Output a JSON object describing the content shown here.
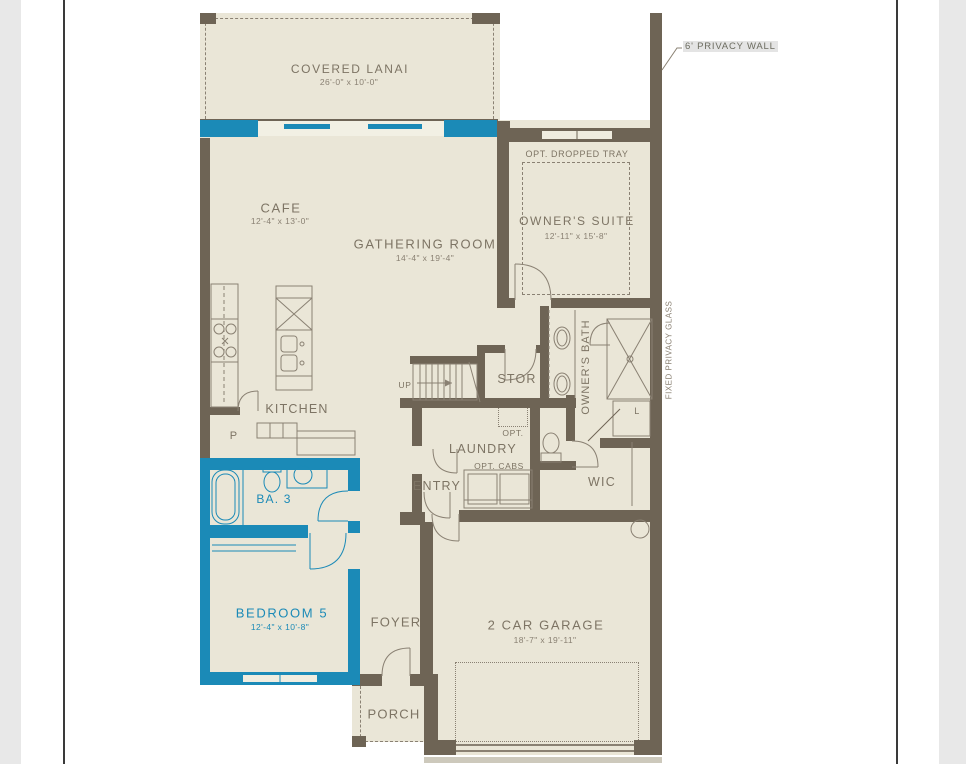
{
  "colors": {
    "wall": "#6e6455",
    "floor": "#eae6d7",
    "line": "#8a8173",
    "text": "#7d7464",
    "accent": "#1b8ab7",
    "margin": "#e8e8e8"
  },
  "rooms": {
    "covered_lanai": {
      "name": "COVERED LANAI",
      "dims": "26'-0\" x 10'-0\""
    },
    "cafe": {
      "name": "CAFE",
      "dims": "12'-4\" x 13'-0\""
    },
    "gathering_room": {
      "name": "GATHERING ROOM",
      "dims": "14'-4\" x 19'-4\""
    },
    "owners_suite": {
      "name": "OWNER'S SUITE",
      "dims": "12'-11\" x 15'-8\""
    },
    "owners_bath": {
      "name": "OWNER'S BATH"
    },
    "kitchen": {
      "name": "KITCHEN"
    },
    "stor": {
      "name": "STOR"
    },
    "laundry": {
      "name": "LAUNDRY"
    },
    "entry": {
      "name": "ENTRY"
    },
    "wic": {
      "name": "WIC"
    },
    "ba3": {
      "name": "BA. 3"
    },
    "bedroom5": {
      "name": "BEDROOM 5",
      "dims": "12'-4\" x 10'-8\""
    },
    "foyer": {
      "name": "FOYER"
    },
    "garage": {
      "name": "2 CAR GARAGE",
      "dims": "18'-7\" x 19'-11\""
    },
    "porch": {
      "name": "PORCH"
    }
  },
  "annotations": {
    "privacy_wall": "6' PRIVACY WALL",
    "fixed_privacy_glass": "FIXED PRIVACY GLASS",
    "opt_dropped_tray": "OPT. DROPPED TRAY",
    "opt_cabs": "OPT. CABS",
    "opt": "OPT.",
    "up": "UP",
    "pantry": "P",
    "linen": "L"
  }
}
